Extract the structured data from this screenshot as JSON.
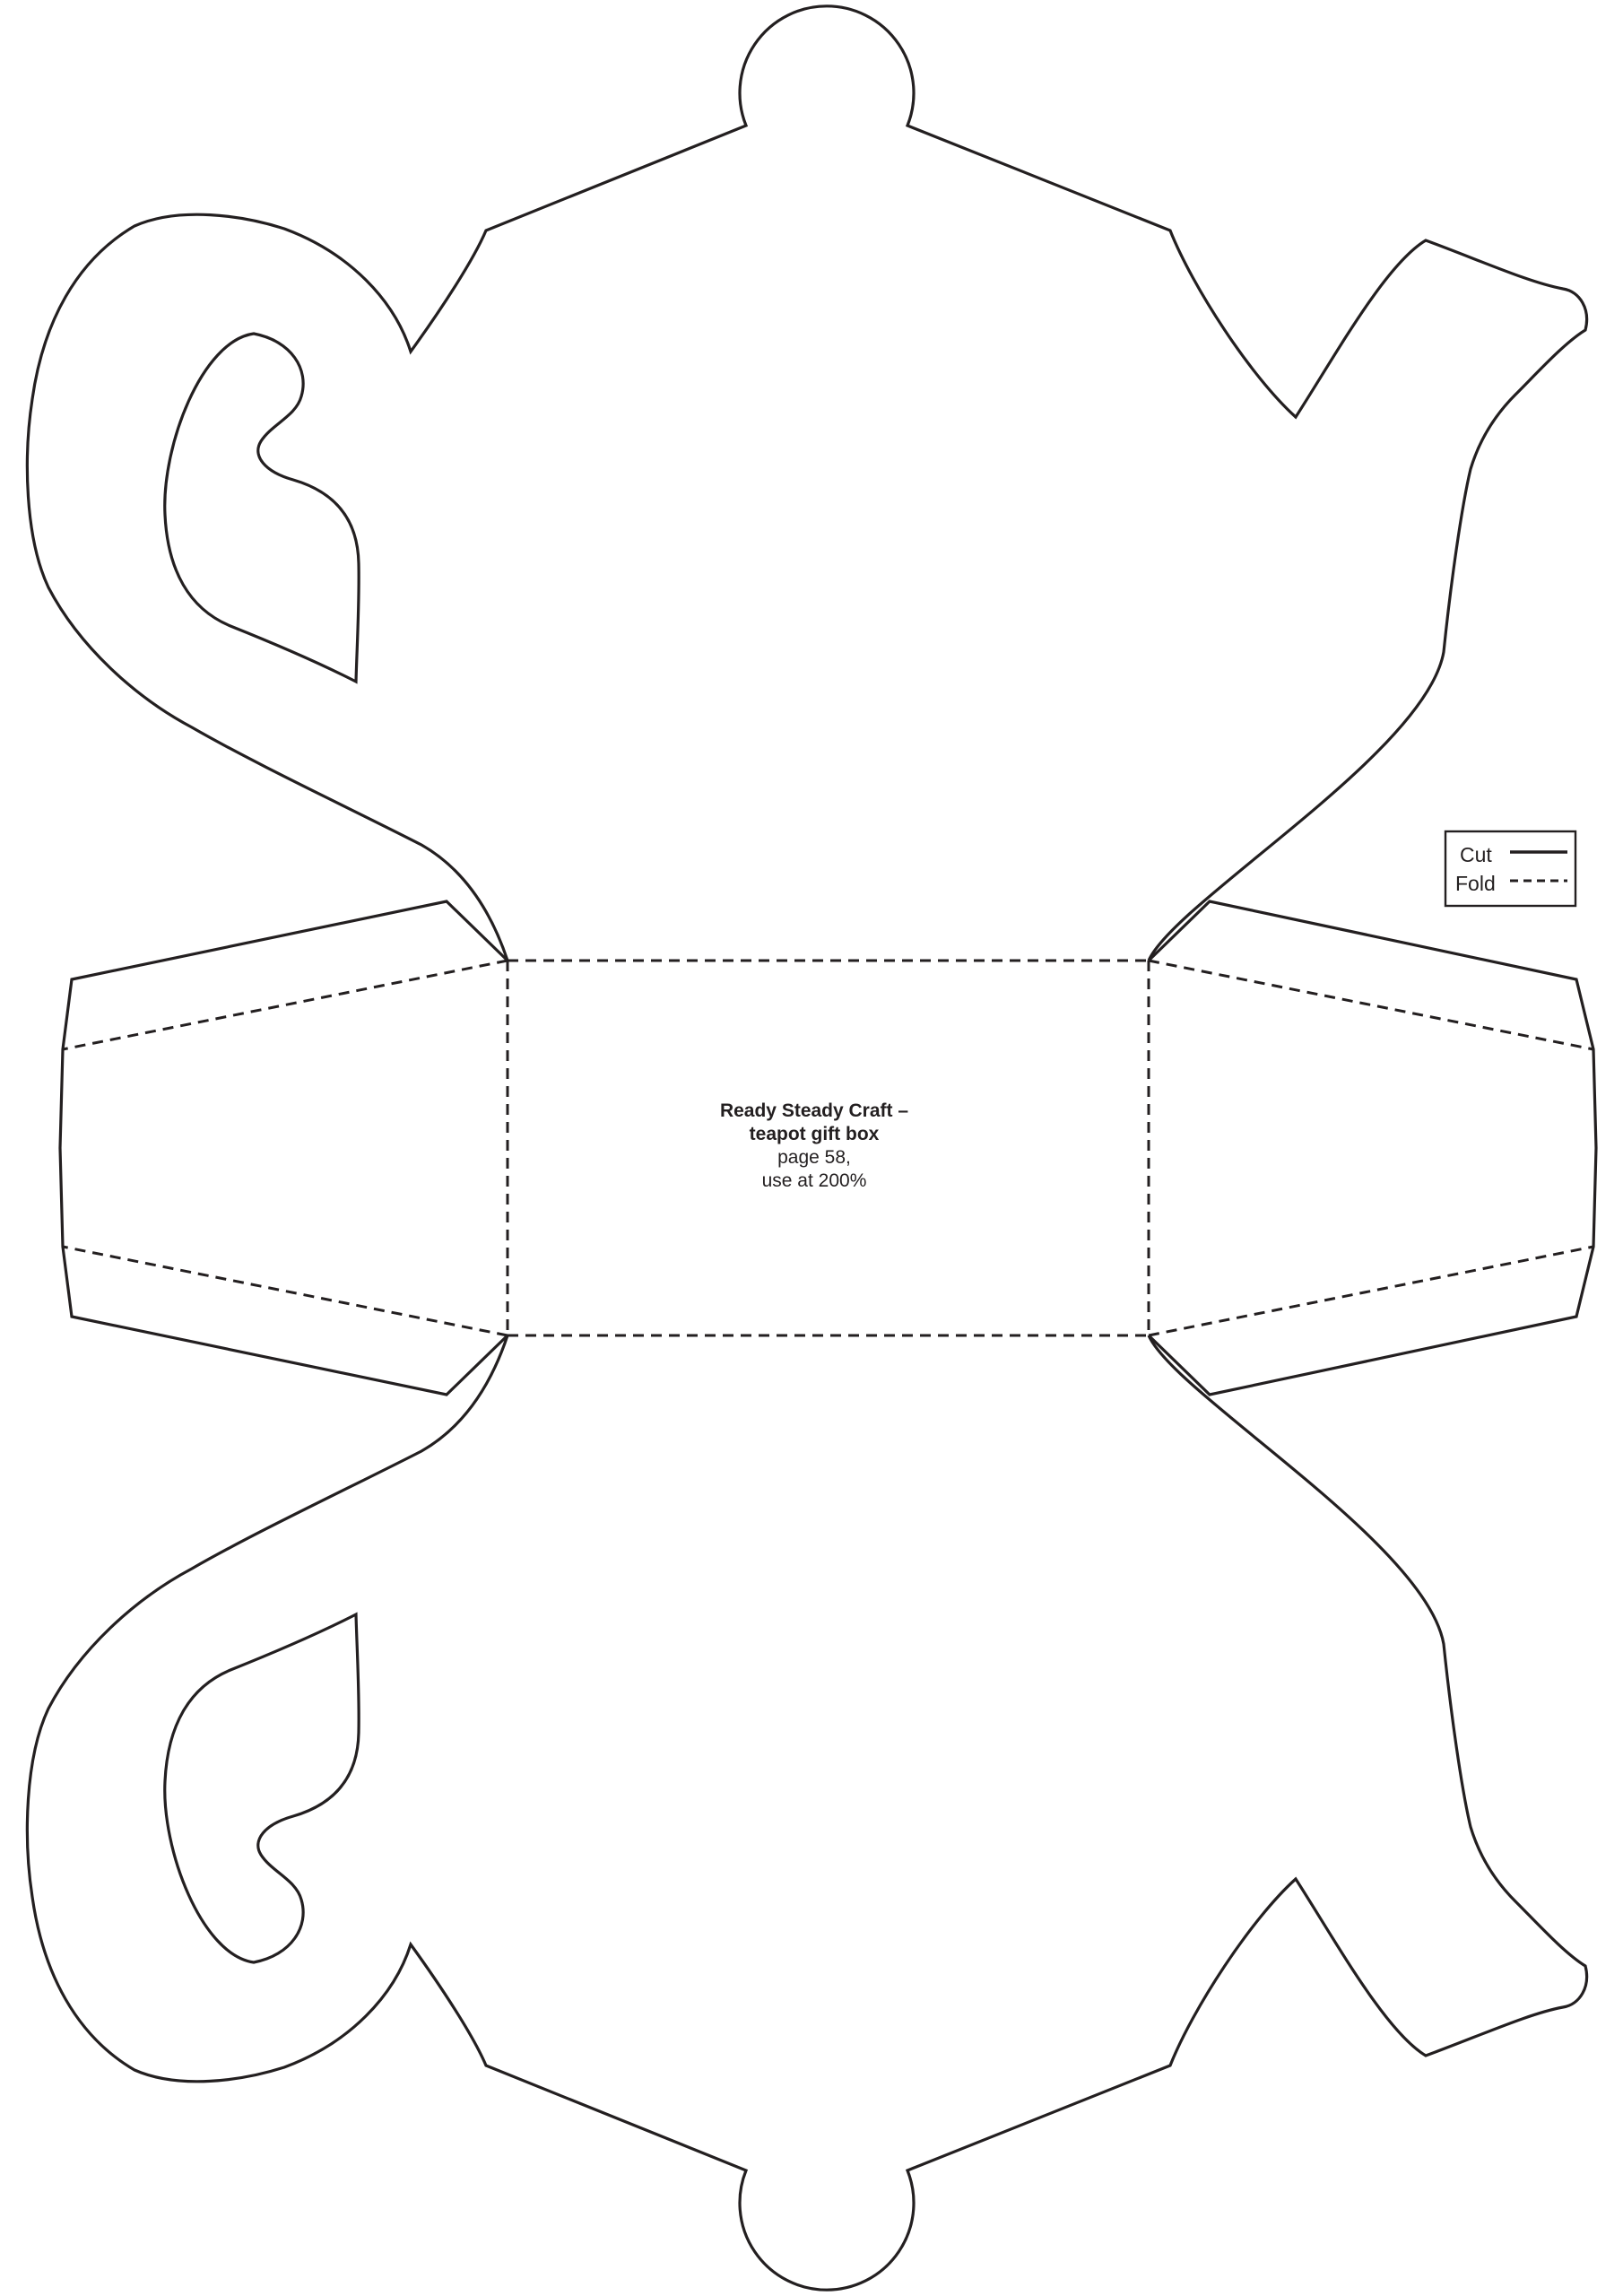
{
  "document": {
    "kind": "craft-template-page"
  },
  "colors": {
    "ink": "#231f20",
    "paper": "#ffffff"
  },
  "legend": {
    "cut_label": "Cut",
    "fold_label": "Fold",
    "cut_style": "solid",
    "fold_style": "dashed"
  },
  "caption": {
    "title_line1": "Ready Steady Craft –",
    "title_line2": "teapot gift box",
    "page_line": "page 58,",
    "scale_line": "use at 200%"
  }
}
